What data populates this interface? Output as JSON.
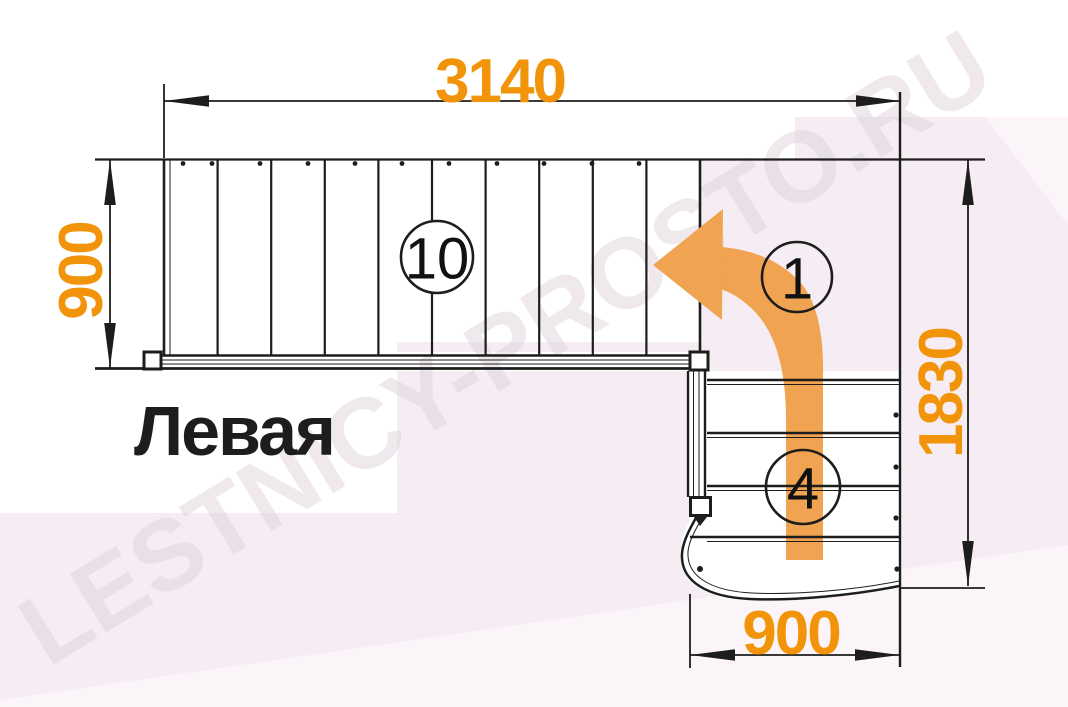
{
  "diagram": {
    "title": "Левая",
    "watermark": "LESTNICY-PROSTO.RU",
    "dimensions": {
      "top_length": "3140",
      "left_width": "900",
      "right_depth": "1830",
      "bottom_width": "900"
    },
    "markers": {
      "upper_flight_step_count": "10",
      "route_start_number": "1",
      "lower_flight_step_count": "4"
    },
    "colors": {
      "dimension_text": "#F2940A",
      "arrow_fill": "#F0A351",
      "line": "#1D1D1B",
      "background_pink": "#F5EDF3",
      "background_pink_light": "#FBF4F9",
      "watermark": "#DCCFD8"
    }
  }
}
